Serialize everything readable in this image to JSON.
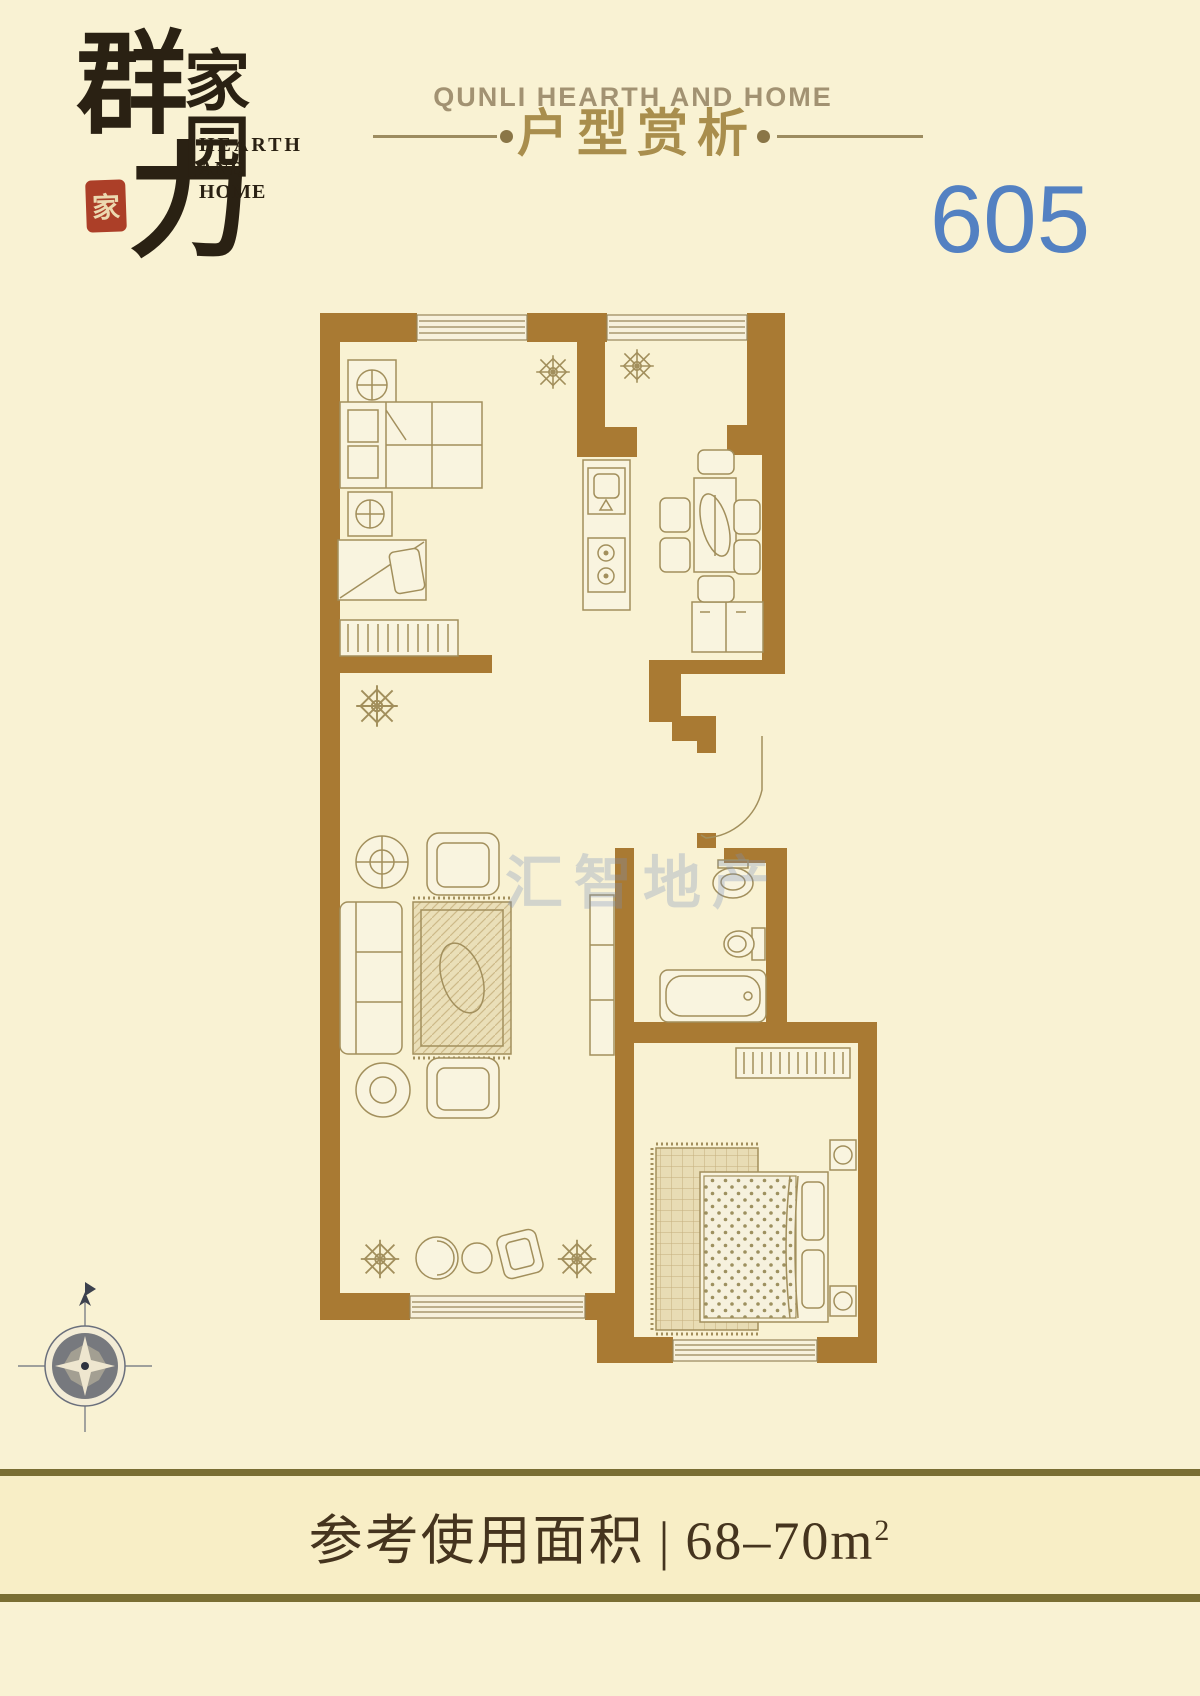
{
  "page": {
    "width": 1200,
    "height": 1696,
    "bg": "#f9f2d3"
  },
  "logo": {
    "main_char_top": "群",
    "main_char_bottom": "力",
    "sub_chars": "家园",
    "tagline_line1": "HEARTH",
    "tagline_line2": "AND HOME",
    "seal_char": "家",
    "ink_color": "#2a2113",
    "seal_color": "#ac3f28"
  },
  "header": {
    "title_en": "QUNLI HEARTH AND HOME",
    "title_cn": "户型赏析",
    "en_color": "#a29272",
    "cn_color": "#a98e4d",
    "rule_color": "#9d8c60"
  },
  "unit_number": {
    "value": "605",
    "color": "#5381c2"
  },
  "watermark": {
    "text": "汇智地产",
    "color": "rgba(120,142,188,0.30)"
  },
  "floor_plan": {
    "wall_color": "#a97a33",
    "furniture_line_color": "#a28f5c",
    "rooms": [
      "bedroom-1",
      "kitchen-dining",
      "living-room",
      "entry-hall",
      "bathroom",
      "bedroom-2"
    ],
    "icons": [
      "plant-icon",
      "compass-rose-icon",
      "window",
      "door-swing-icon",
      "bed-icon",
      "wardrobe-icon",
      "sofa-icon",
      "rug-icon",
      "tv-stand-icon",
      "dining-table-icon",
      "sink-icon",
      "stove-icon",
      "fridge-icon",
      "bathtub-icon",
      "toilet-icon",
      "wash-basin-icon",
      "nightstand-icon",
      "dresser-icon"
    ]
  },
  "footer": {
    "area_label": "参考使用面积",
    "separator": "|",
    "area_value": "68–70m",
    "area_sup": "2",
    "text_color": "#45341e",
    "rule_color": "#7a6e33",
    "band_bg": "#f8eec6"
  }
}
